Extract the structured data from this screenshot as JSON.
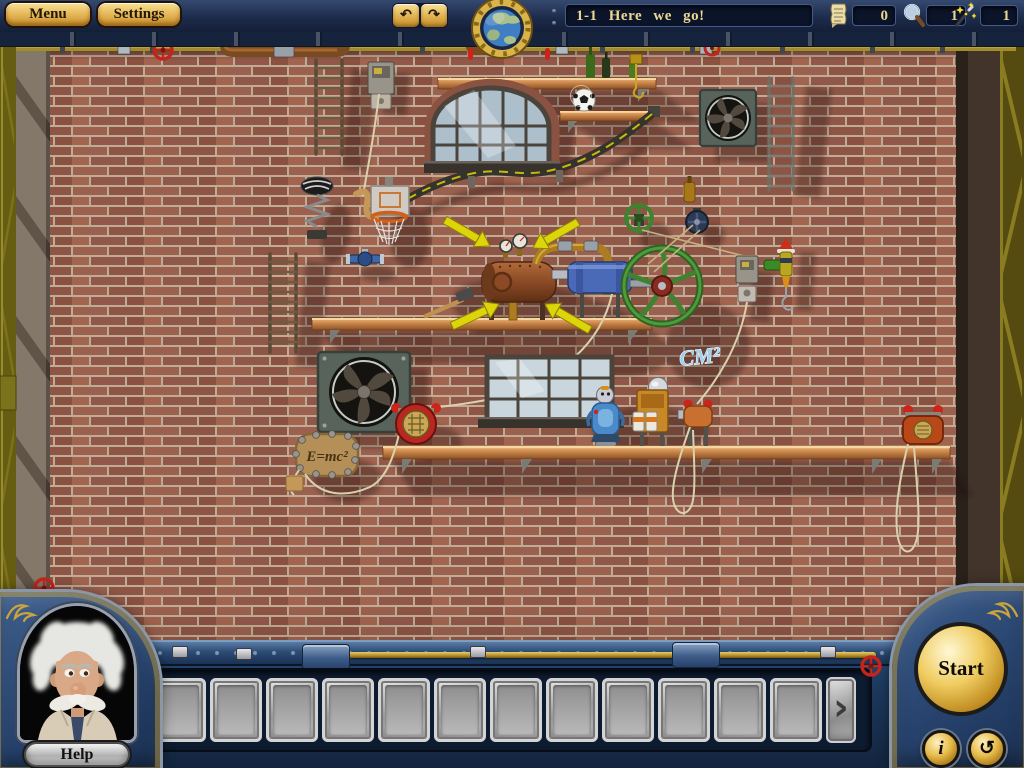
{
  "topbar": {
    "menu_label": "Menu",
    "settings_label": "Settings",
    "undo_icon": "↶",
    "redo_icon": "↷",
    "level_title": "1-1 Here we go!",
    "counters": {
      "notes": {
        "icon": "scroll-icon",
        "value": "0"
      },
      "magnifier": {
        "icon": "magnifier-icon",
        "value": "1"
      },
      "wand": {
        "icon": "wand-icon",
        "value": "1"
      }
    }
  },
  "playfield": {
    "cm2_label": "CM²",
    "emc2_label": "E=mc²"
  },
  "console": {
    "help_label": "Help",
    "start_label": "Start",
    "info_icon": "i",
    "reset_icon": "↺",
    "tray_prev_icon": "‹",
    "tray_next_icon": "›",
    "slot_count": 12
  },
  "colors": {
    "gold": "#e2b252",
    "navy_panel": "#27436e",
    "brick": "#9b604e",
    "mortar": "#bfac96",
    "hint_arrow": "#ddd40a",
    "start_gold": "#f0cd62"
  }
}
